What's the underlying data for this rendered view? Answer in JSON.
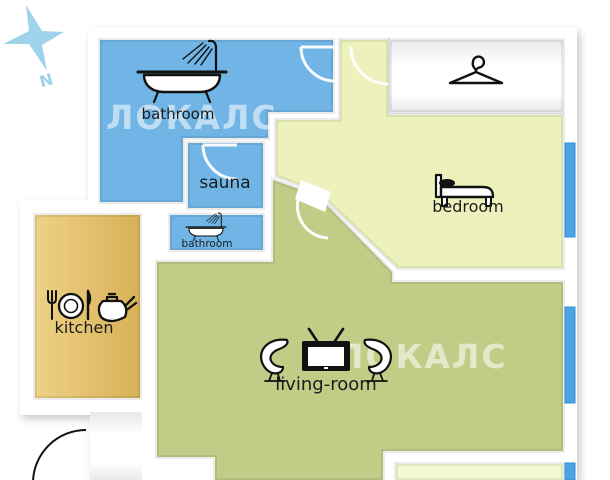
{
  "compass": {
    "label": "N",
    "color": "#9fd2eb"
  },
  "watermark": {
    "text": "ЛОКАЛС"
  },
  "colors": {
    "wet_room": "#71b5e6",
    "kitchen_a": "#eed187",
    "kitchen_b": "#d7b156",
    "living": "#c3cc87",
    "hall_bedroom": "#edf2bd",
    "balcony": "#f3f8d1",
    "white_room_a": "#e9e9e9",
    "white_room_b": "#ffffff",
    "window": "#4aa3e2",
    "watermark_fill": "rgba(255,255,255,0.55)"
  },
  "rooms": {
    "bathroom_main": {
      "label": "bathroom",
      "icon": "bathtub-shower-icon"
    },
    "sauna": {
      "label": "sauna"
    },
    "bathroom_small": {
      "label": "bathroom",
      "icon": "bathtub-shower-icon"
    },
    "kitchen": {
      "label": "kitchen",
      "icon": "cutlery-teapot-icon"
    },
    "bedroom": {
      "label": "bedroom",
      "icon": "bed-icon"
    },
    "living_room": {
      "label": "living-room",
      "icon": "tv-armchairs-icon"
    },
    "closet": {
      "icon": "hanger-icon"
    },
    "balcony": {},
    "hallway": {}
  }
}
